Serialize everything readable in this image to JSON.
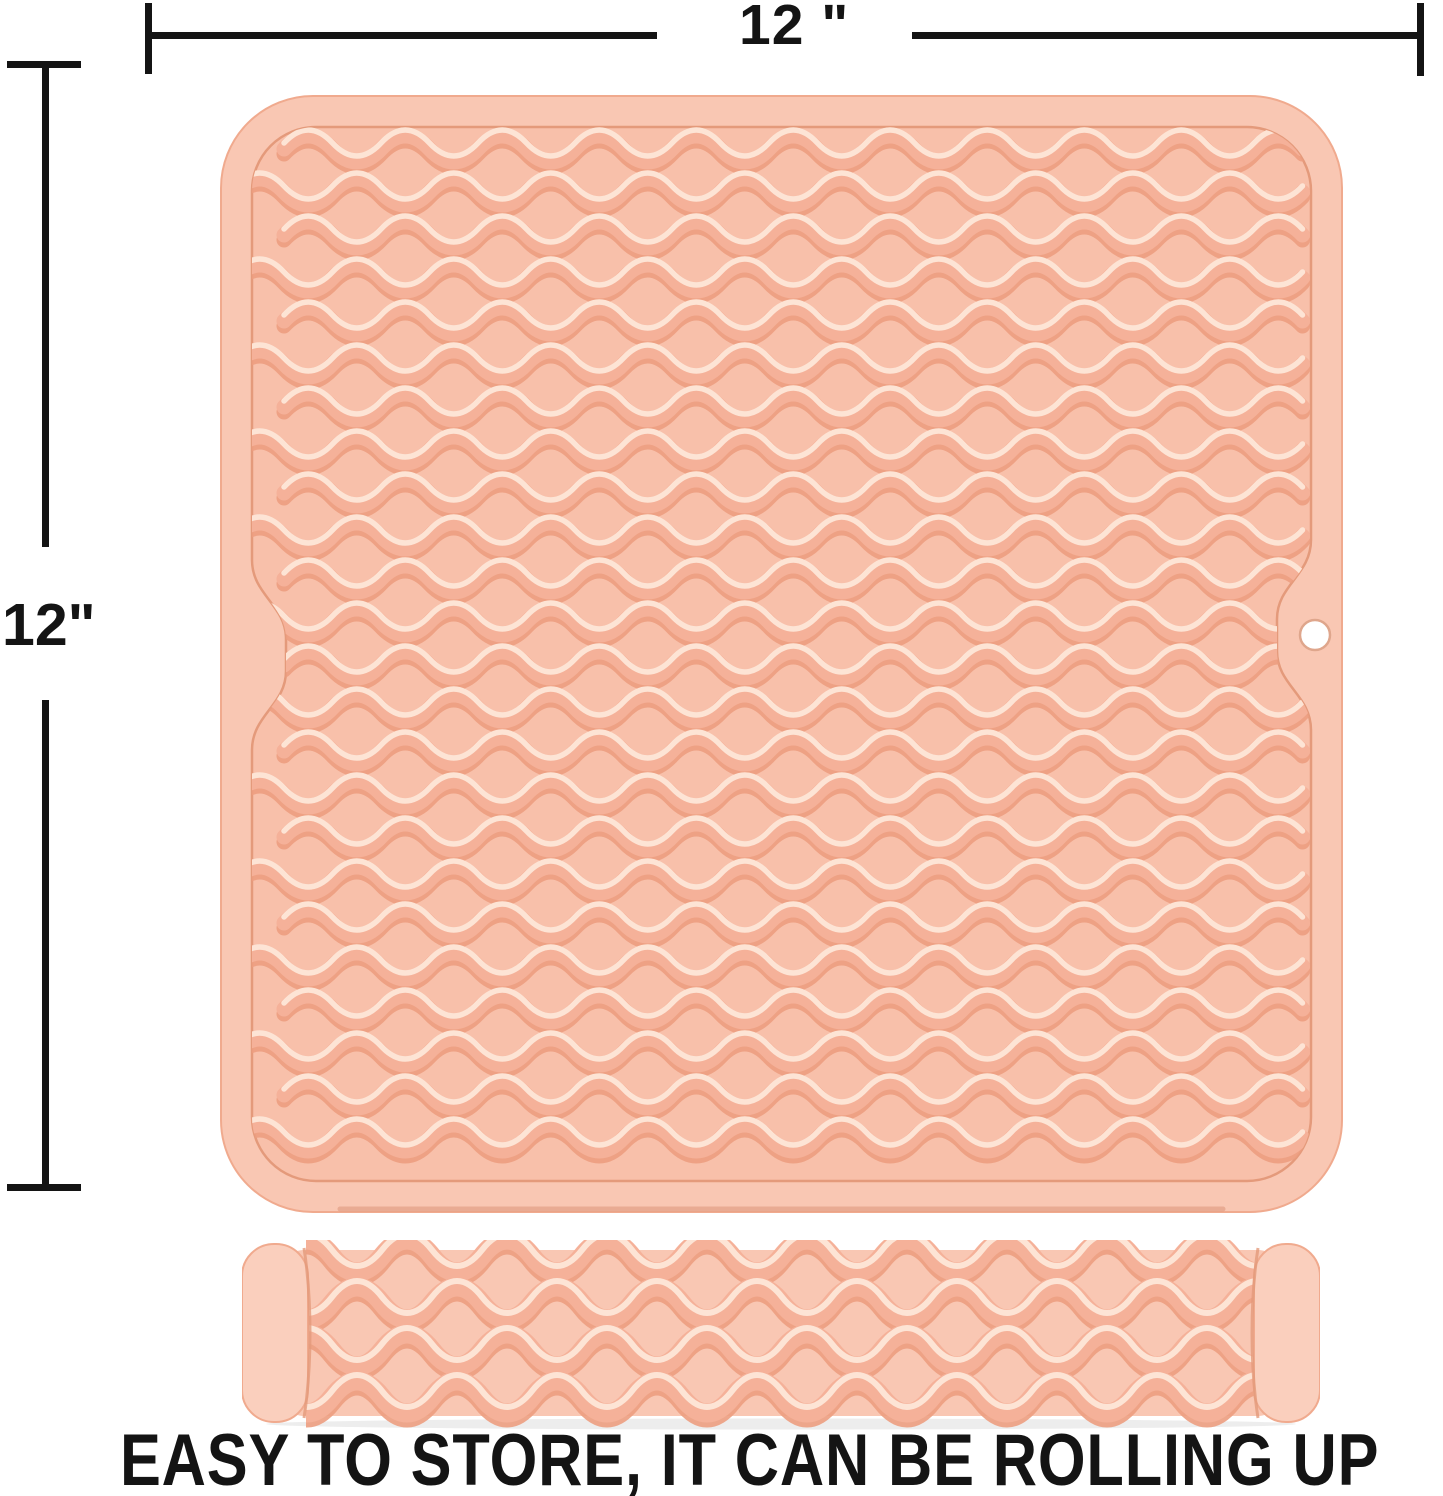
{
  "annotations": {
    "top_width_label": "12 \"",
    "left_height_label": "12\""
  },
  "caption": {
    "text": "EASY TO STORE, IT CAN BE ROLLING UP"
  },
  "product": {
    "flat_mat": "silicone dish drying mat, wave textured, square",
    "rolled_mat": "same mat rolled up into a cylinder",
    "hanging_hole": "round hang hole on right edge"
  },
  "colors": {
    "background": "#ffffff",
    "annotation": "#141414",
    "mat_rim": "#f9c7b3",
    "mat_recessed": "#f8c0aa",
    "ridge": "#f5b199",
    "ridge_shadow": "#ec9d7f",
    "ridge_highlight": "#fde4d5",
    "groove": "#e49a7b",
    "outer_edge": "#f0aa8e",
    "bottom_edge_shadow": "#dd9478",
    "cap": "#facfbd",
    "hole_fill": "#ffffff",
    "hole_rim": "#dfa68c",
    "shadow": "rgba(0,0,0,0.07)"
  }
}
